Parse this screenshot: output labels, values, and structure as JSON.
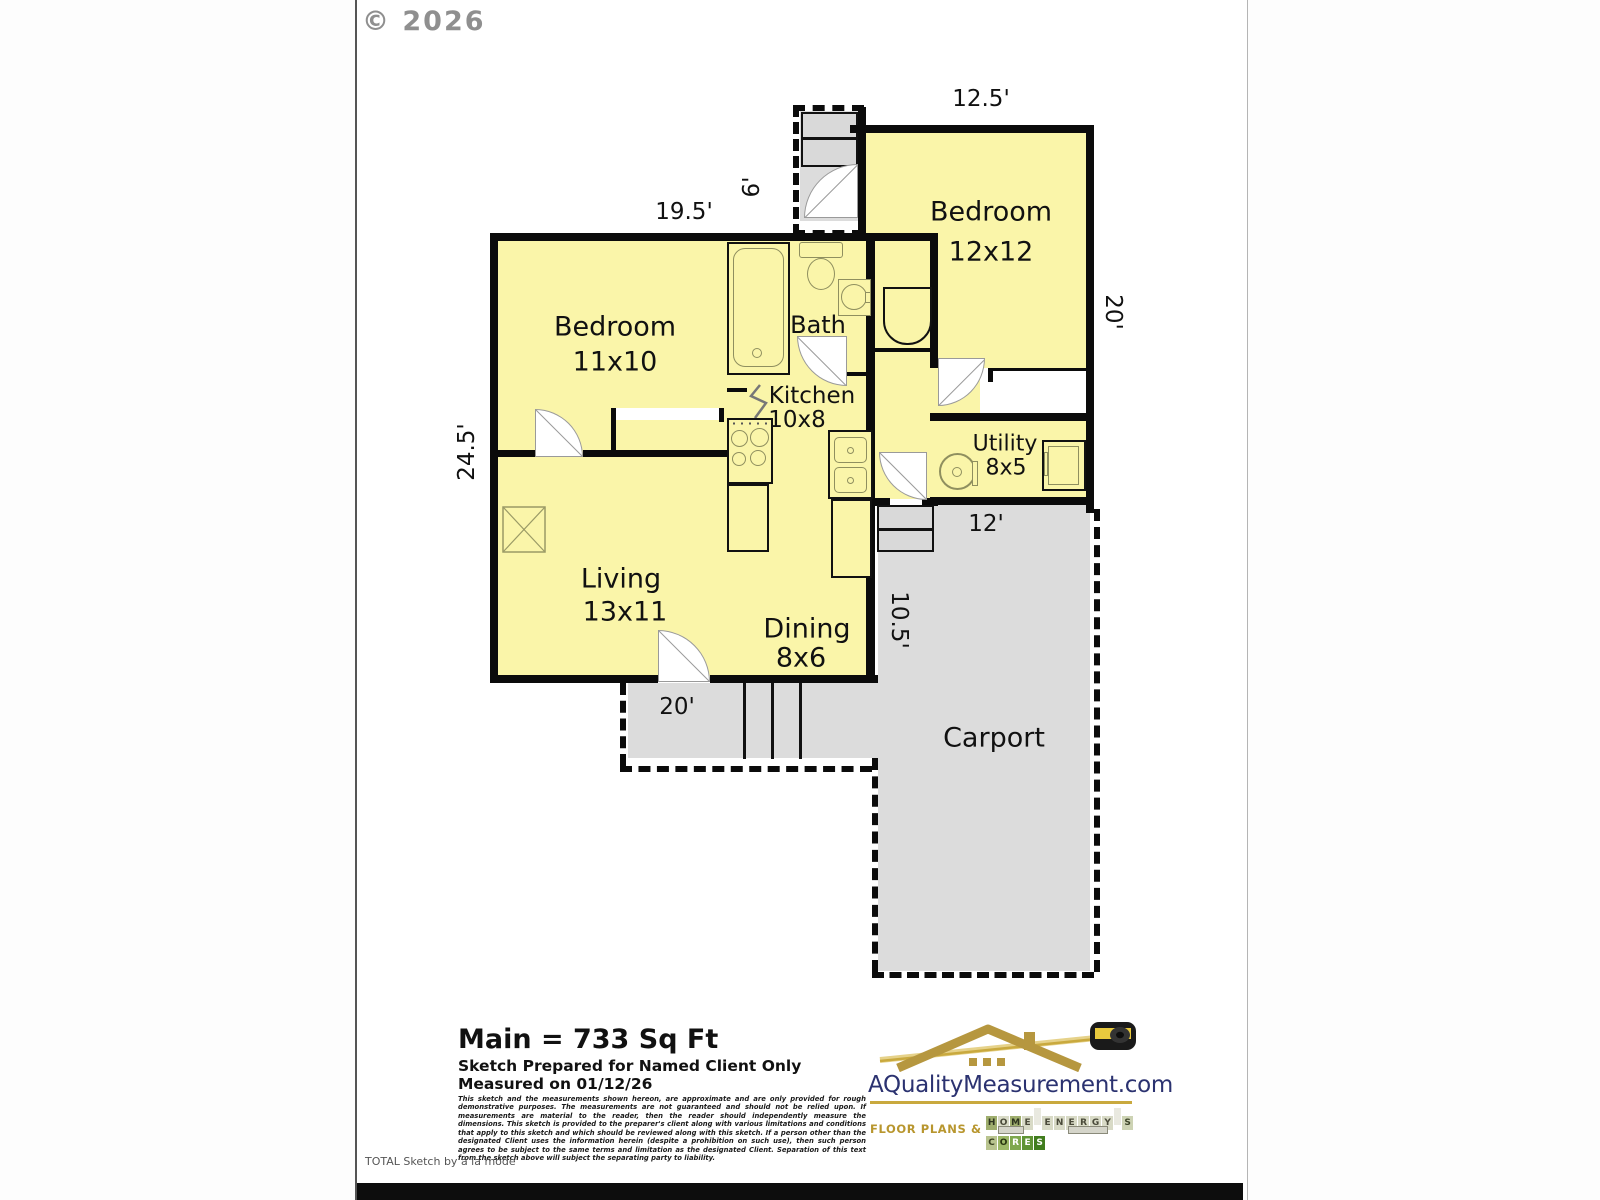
{
  "copyright": "© 2026",
  "plan": {
    "rooms": {
      "bedroom12": {
        "name": "Bedroom",
        "size": "12x12"
      },
      "bedroom11": {
        "name": "Bedroom",
        "size": "11x10"
      },
      "bath": {
        "name": "Bath"
      },
      "kitchen": {
        "name": "Kitchen",
        "size": "10x8"
      },
      "utility": {
        "name": "Utility",
        "size": "8x5"
      },
      "living": {
        "name": "Living",
        "size": "13x11"
      },
      "dining": {
        "name": "Dining",
        "size": "8x6"
      },
      "carport": {
        "name": "Carport"
      }
    },
    "dimensions": {
      "bedroom12_width": "12.5'",
      "back_porch_depth": "6'",
      "main_width": "19.5'",
      "right_height": "20'",
      "main_height": "24.5'",
      "utility_width": "12'",
      "carport_upper_width": "10.5'",
      "front_porch_width": "20'"
    },
    "colors": {
      "room_fill": "#FAF5A9",
      "exterior_fill": "#DCDCDC",
      "wall": "#0b0b0b"
    }
  },
  "summary": {
    "area": "Main = 733 Sq Ft",
    "prepared_for": "Sketch Prepared for Named Client Only",
    "measured_on": "Measured on 01/12/26"
  },
  "disclaimer": "This sketch and the measurements shown hereon, are approximate and are only provided for rough demonstrative purposes.  The measurements are not guaranteed and should not be relied upon.  If measurements are material to the reader, then the reader should independently measure the dimensions.  This sketch is provided to the preparer's client along with various limitations and conditions that apply to this sketch and which should be reviewed along with this sketch.  If a person other than the designated Client uses the information herein (despite a prohibition on such use), then such person agrees to be subject to the same terms and limitation as the designated Client.  Separation of this text from the sketch above will subject the separating party to liability.",
  "logo": {
    "site": "AQualityMeasurement.com",
    "tagline_prefix": "Floor Plans &",
    "accent_gold": "#c9a93e",
    "navy": "#2b3270",
    "tiles": [
      {
        "ch": "H",
        "bg": "#9fae6e",
        "fg": "#2e3420"
      },
      {
        "ch": "O",
        "bg": "#d8dac6",
        "fg": "#4a4a3a"
      },
      {
        "ch": "M",
        "bg": "#9fae6e",
        "fg": "#2e3420"
      },
      {
        "ch": "E",
        "bg": "#d8dac6",
        "fg": "#4a4a3a"
      },
      {
        "ch": "",
        "bg": "#e9e9e0",
        "fg": "#333333"
      },
      {
        "ch": "E",
        "bg": "#d8dac6",
        "fg": "#4a4a3a"
      },
      {
        "ch": "N",
        "bg": "#d8dac6",
        "fg": "#4a4a3a"
      },
      {
        "ch": "E",
        "bg": "#d8dac6",
        "fg": "#4a4a3a"
      },
      {
        "ch": "R",
        "bg": "#d8dac6",
        "fg": "#4a4a3a"
      },
      {
        "ch": "G",
        "bg": "#d8dac6",
        "fg": "#4a4a3a"
      },
      {
        "ch": "Y",
        "bg": "#d8dac6",
        "fg": "#4a4a3a"
      },
      {
        "ch": "",
        "bg": "#e9e9e0",
        "fg": "#333333"
      },
      {
        "ch": "S",
        "bg": "#cdd3b4",
        "fg": "#3c4428"
      },
      {
        "ch": "C",
        "bg": "#b9c48f",
        "fg": "#38401f"
      },
      {
        "ch": "O",
        "bg": "#9db868",
        "fg": "#27330f"
      },
      {
        "ch": "R",
        "bg": "#7fa84e",
        "fg": "#ffffff"
      },
      {
        "ch": "E",
        "bg": "#5f9434",
        "fg": "#ffffff"
      },
      {
        "ch": "S",
        "bg": "#417d1e",
        "fg": "#ffffff"
      }
    ]
  },
  "footer": "TOTAL Sketch by a la mode"
}
